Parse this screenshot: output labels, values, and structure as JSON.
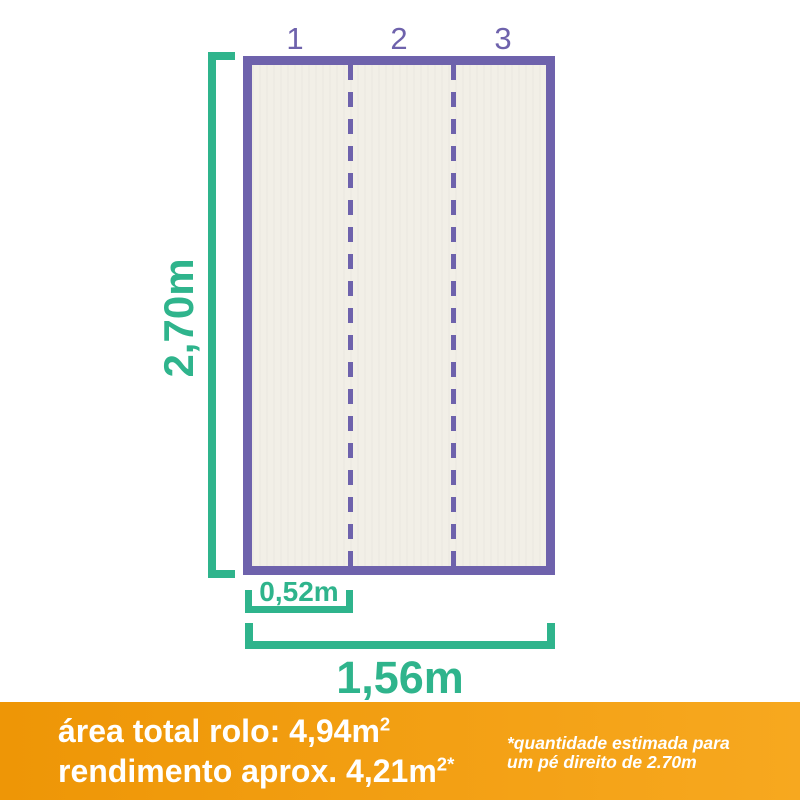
{
  "diagram": {
    "strip_numbers": [
      "1",
      "2",
      "3"
    ],
    "height_label": "2,70m",
    "strip_width_label": "0,52m",
    "total_width_label": "1,56m"
  },
  "footer": {
    "area_text": "área total rolo: 4,94m",
    "area_sup": "2",
    "yield_text": "rendimento aprox. 4,21m",
    "yield_sup": "2*",
    "note_line1": "*quantidade estimada para",
    "note_line2": "um pé direito de 2.70m"
  },
  "colors": {
    "purple": "#6E62AC",
    "green": "#2FB48C",
    "orange_left": "#EE9606",
    "orange_right": "#F7A81F",
    "paper": "#F2EFE7",
    "text_white": "#FFFFFF"
  }
}
